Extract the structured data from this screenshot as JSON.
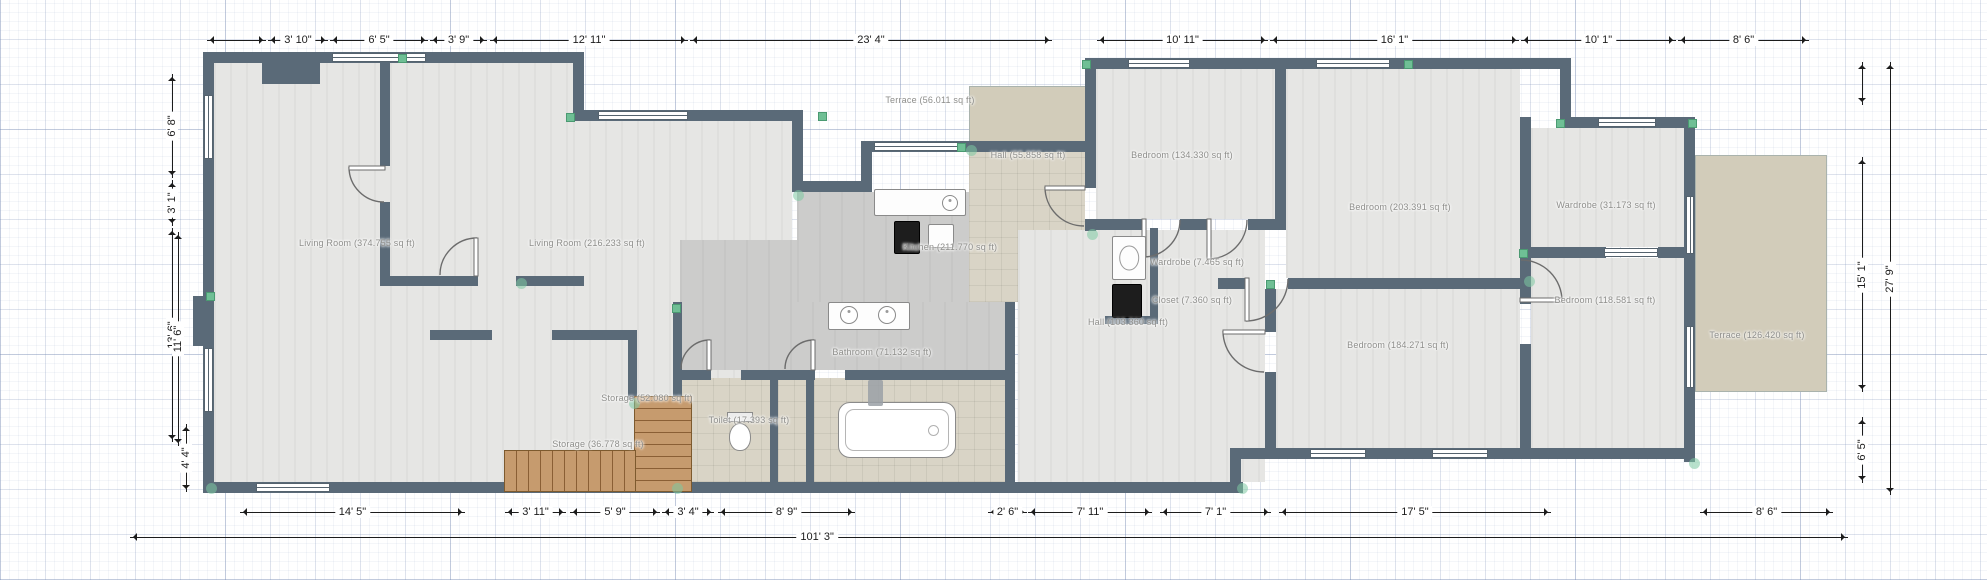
{
  "app": {
    "name": "floor-plan-editor",
    "view": "2d-plan",
    "wall_color": "#5a6a78",
    "accent_marker_color": "#6fbf95"
  },
  "rooms": [
    {
      "id": "living-room-1",
      "label": "Living Room (374.755 sq ft)"
    },
    {
      "id": "living-room-2",
      "label": "Living Room (216.233 sq ft)"
    },
    {
      "id": "kitchen",
      "label": "Kitchen (211.770 sq ft)"
    },
    {
      "id": "terrace-top",
      "label": "Terrace (56.011 sq ft)"
    },
    {
      "id": "hall-top",
      "label": "Hall (55.858 sq ft)"
    },
    {
      "id": "bedroom-1",
      "label": "Bedroom (134.330 sq ft)"
    },
    {
      "id": "bedroom-2",
      "label": "Bedroom (203.391 sq ft)"
    },
    {
      "id": "wardrobe-room",
      "label": "Wardrobe (31.173 sq ft)"
    },
    {
      "id": "bedroom-3",
      "label": "Bedroom (118.581 sq ft)"
    },
    {
      "id": "terrace-right",
      "label": "Terrace (126.420 sq ft)"
    },
    {
      "id": "bedroom-4",
      "label": "Bedroom (184.271 sq ft)"
    },
    {
      "id": "hall-2",
      "label": "Hall (103.360 sq ft)"
    },
    {
      "id": "wardrobe-small",
      "label": "Wardrobe (7.465 sq ft)"
    },
    {
      "id": "closet",
      "label": "Closet (7.360 sq ft)"
    },
    {
      "id": "storage-1",
      "label": "Storage (52.080 sq ft)"
    },
    {
      "id": "storage-2",
      "label": "Storage (36.778 sq ft)"
    },
    {
      "id": "toilet-room",
      "label": "Toilet (17.393 sq ft)"
    },
    {
      "id": "bathroom",
      "label": "Bathroom (71.132 sq ft)"
    }
  ],
  "dims": {
    "top": [
      "3' 10\"",
      "6' 5\"",
      "3' 9\"",
      "12' 11\"",
      "23' 4\"",
      "10' 11\"",
      "16' 1\"",
      "10' 1\"",
      "8' 6\""
    ],
    "bottom": [
      "14' 5\"",
      "3' 11\"",
      "5' 9\"",
      "3' 4\"",
      "8' 9\"",
      "2' 6\"",
      "7' 11\"",
      "7' 1\"",
      "17' 5\"",
      "8' 6\""
    ],
    "left": [
      "6' 8\"",
      "3' 1\"",
      "13' 6\"",
      "11' 6\"",
      "4' 4\""
    ],
    "right": [
      "15' 1\"",
      "6' 5\"",
      "27' 9\""
    ],
    "overall_bottom": "101' 3\""
  },
  "objects": [
    "kitchen-counter",
    "stove",
    "washing-machine",
    "closet-box",
    "vanity-sinks",
    "bathtub",
    "toilet",
    "bath-mat",
    "stairs",
    "chimney-block"
  ]
}
